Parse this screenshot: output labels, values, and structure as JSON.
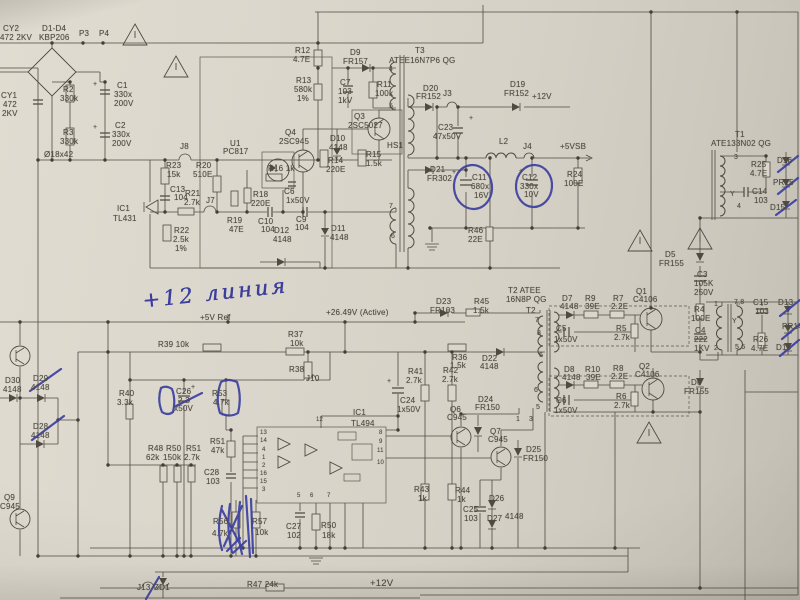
{
  "annotations": {
    "handwriting": "+12 линия"
  },
  "colors": {
    "paper": "#d8d4c9",
    "ink": "#4e4a40",
    "pen": "#3c3f9f"
  },
  "labels": [
    [
      "CY2",
      3,
      24
    ],
    [
      "472 2KV",
      0,
      33
    ],
    [
      "D1-D4",
      42,
      24
    ],
    [
      "KBP206",
      39,
      33
    ],
    [
      "P3",
      79,
      29
    ],
    [
      "P4",
      99,
      29
    ],
    [
      "C1",
      117,
      81
    ],
    [
      "330x",
      114,
      90
    ],
    [
      "200V",
      114,
      99
    ],
    [
      "R2",
      63,
      85
    ],
    [
      "330k",
      60,
      94
    ],
    [
      "R3",
      63,
      128
    ],
    [
      "330k",
      60,
      137
    ],
    [
      "C2",
      115,
      121
    ],
    [
      "330x",
      112,
      130
    ],
    [
      "200V",
      112,
      139
    ],
    [
      "CY1",
      1,
      91
    ],
    [
      "472",
      3,
      100
    ],
    [
      "2KV",
      2,
      109
    ],
    [
      "Ø18x42",
      44,
      150
    ],
    [
      "J8",
      180,
      142
    ],
    [
      "R23",
      166,
      161
    ],
    [
      "15k",
      167,
      170
    ],
    [
      "C13",
      170,
      185
    ],
    [
      "104",
      174,
      193
    ],
    [
      "R20",
      196,
      161
    ],
    [
      "510E",
      193,
      170
    ],
    [
      "R21",
      185,
      189
    ],
    [
      "2.7k",
      184,
      198
    ],
    [
      "J7",
      206,
      196
    ],
    [
      "U1",
      230,
      139
    ],
    [
      "PC817",
      223,
      147
    ],
    [
      "R18",
      253,
      190
    ],
    [
      "220E",
      251,
      199
    ],
    [
      "R19",
      227,
      216
    ],
    [
      "47E",
      229,
      225
    ],
    [
      "R22",
      174,
      226
    ],
    [
      "2.5k",
      173,
      235
    ],
    [
      "1%",
      175,
      244
    ],
    [
      "IC1",
      117,
      204
    ],
    [
      "TL431",
      113,
      214
    ],
    [
      "Q4",
      285,
      128
    ],
    [
      "2SC945",
      279,
      137
    ],
    [
      "R16 1k",
      268,
      164
    ],
    [
      "C6",
      284,
      187
    ],
    [
      "1x50V",
      286,
      196
    ],
    [
      "C10",
      258,
      217
    ],
    [
      "104",
      261,
      225
    ],
    [
      "D12",
      274,
      226
    ],
    [
      "4148",
      273,
      235
    ],
    [
      "C9",
      296,
      215
    ],
    [
      "104",
      295,
      223
    ],
    [
      "D11",
      331,
      224
    ],
    [
      "4148",
      330,
      233
    ],
    [
      "Q3",
      354,
      112
    ],
    [
      "2SC5027",
      348,
      121
    ],
    [
      "HS1",
      387,
      141
    ],
    [
      "D10",
      330,
      134
    ],
    [
      "4148",
      329,
      143
    ],
    [
      "R14",
      328,
      156
    ],
    [
      "220E",
      326,
      165
    ],
    [
      "R15",
      366,
      150
    ],
    [
      "1.5k",
      366,
      159
    ],
    [
      "R12",
      295,
      46
    ],
    [
      "4.7E",
      293,
      55
    ],
    [
      "D9",
      350,
      48
    ],
    [
      "FR157",
      343,
      57
    ],
    [
      "T3",
      415,
      46
    ],
    [
      "ATEE16N7P6 QG",
      389,
      56
    ],
    [
      "R13",
      296,
      76
    ],
    [
      "580k",
      294,
      85
    ],
    [
      "1%",
      297,
      94
    ],
    [
      "C7",
      340,
      78
    ],
    [
      "103",
      338,
      87
    ],
    [
      "1kV",
      338,
      96
    ],
    [
      "R11",
      377,
      80
    ],
    [
      "100k",
      375,
      89
    ],
    [
      "4",
      389,
      66,
      "s7"
    ],
    [
      "5",
      389,
      103,
      "s7"
    ],
    [
      "7",
      389,
      203,
      "s7"
    ],
    [
      "6",
      391,
      233,
      "s7"
    ],
    [
      "D20",
      423,
      84
    ],
    [
      "FR152",
      416,
      92
    ],
    [
      "J3",
      443,
      89
    ],
    [
      "C23",
      438,
      123
    ],
    [
      "47x50V",
      433,
      132
    ],
    [
      "D19",
      510,
      80
    ],
    [
      "FR152",
      504,
      89
    ],
    [
      "+12V",
      532,
      92
    ],
    [
      "L2",
      499,
      137
    ],
    [
      "J4",
      523,
      142
    ],
    [
      "+5VSB",
      560,
      142
    ],
    [
      "D21",
      430,
      165
    ],
    [
      "FR302",
      427,
      174
    ],
    [
      "C11",
      472,
      173
    ],
    [
      "680x",
      471,
      182
    ],
    [
      "16V",
      474,
      191
    ],
    [
      "C12",
      522,
      173
    ],
    [
      "330x",
      520,
      182
    ],
    [
      "10V",
      524,
      190
    ],
    [
      "R24",
      567,
      170
    ],
    [
      "100E",
      564,
      179
    ],
    [
      "R46",
      468,
      226
    ],
    [
      "22E",
      468,
      235
    ],
    [
      "+",
      93,
      81,
      "s7"
    ],
    [
      "+",
      93,
      124,
      "s7"
    ],
    [
      "+",
      469,
      115,
      "s7"
    ],
    [
      "+",
      452,
      169,
      "s7"
    ],
    [
      "+",
      519,
      168,
      "s7"
    ],
    [
      "+",
      387,
      378,
      "s7"
    ],
    [
      "+",
      191,
      384,
      "s7"
    ],
    [
      "T1",
      735,
      130
    ],
    [
      "ATE133N02 QG",
      711,
      139
    ],
    [
      "3",
      734,
      154,
      "s7"
    ],
    [
      "Y",
      730,
      191,
      "s7"
    ],
    [
      "4",
      737,
      203,
      "s7"
    ],
    [
      "R25",
      751,
      160
    ],
    [
      "4.7E",
      750,
      169
    ],
    [
      "D16",
      777,
      156
    ],
    [
      "PR15",
      773,
      178
    ],
    [
      "C14",
      752,
      187
    ],
    [
      "103",
      754,
      196
    ],
    [
      "D15",
      770,
      203
    ],
    [
      "D5",
      665,
      250
    ],
    [
      "FR155",
      659,
      259
    ],
    [
      "C3",
      697,
      270
    ],
    [
      "105K",
      694,
      279
    ],
    [
      "250V",
      694,
      288
    ],
    [
      "R4",
      694,
      305
    ],
    [
      "100E",
      691,
      314
    ],
    [
      "C4",
      695,
      326
    ],
    [
      "222",
      694,
      335
    ],
    [
      "1KV",
      694,
      344
    ],
    [
      "1",
      714,
      301,
      "s7"
    ],
    [
      "2",
      714,
      345,
      "s7"
    ],
    [
      "7,8",
      734,
      299,
      "s7"
    ],
    [
      "C15",
      753,
      298
    ],
    [
      "103",
      755,
      307
    ],
    [
      "Y",
      732,
      318,
      "s7"
    ],
    [
      "5,6",
      735,
      344,
      "s7"
    ],
    [
      "R26",
      753,
      335
    ],
    [
      "4.7E",
      751,
      344
    ],
    [
      "D13",
      778,
      298
    ],
    [
      "PR14",
      782,
      322
    ],
    [
      "D14",
      776,
      343
    ],
    [
      "T2 ATEE",
      508,
      286
    ],
    [
      "16N8P QG",
      506,
      295
    ],
    [
      "T2",
      526,
      306
    ],
    [
      "D7",
      562,
      294
    ],
    [
      "4148",
      560,
      302
    ],
    [
      "R9",
      585,
      294
    ],
    [
      "39E",
      585,
      302
    ],
    [
      "R7",
      613,
      294
    ],
    [
      "2.2E",
      611,
      302
    ],
    [
      "Q1",
      636,
      287
    ],
    [
      "C4106",
      633,
      295
    ],
    [
      "C5",
      556,
      324
    ],
    [
      "1x50V",
      554,
      335
    ],
    [
      "R5",
      616,
      324
    ],
    [
      "2.7k",
      614,
      333
    ],
    [
      "7",
      535,
      317,
      "s7"
    ],
    [
      "8",
      537,
      330,
      "s7"
    ],
    [
      "6",
      539,
      352,
      "s7"
    ],
    [
      "D8",
      564,
      365
    ],
    [
      "4148",
      562,
      373
    ],
    [
      "R10",
      585,
      365
    ],
    [
      "39E",
      586,
      373
    ],
    [
      "R8",
      613,
      364
    ],
    [
      "2.2E",
      611,
      372
    ],
    [
      "Q2",
      639,
      362
    ],
    [
      "C4106",
      635,
      370
    ],
    [
      "C6",
      556,
      396
    ],
    [
      "1x50V",
      554,
      406
    ],
    [
      "R6",
      616,
      392
    ],
    [
      "2.7k",
      614,
      401
    ],
    [
      "6",
      534,
      387,
      "s7"
    ],
    [
      "5",
      536,
      404,
      "s7"
    ],
    [
      "D6",
      691,
      378
    ],
    [
      "FR155",
      684,
      387
    ],
    [
      "+5V Ref",
      200,
      313
    ],
    [
      "R39 10k",
      158,
      340
    ],
    [
      "R37",
      288,
      330
    ],
    [
      "10k",
      290,
      339
    ],
    [
      "R38",
      289,
      365
    ],
    [
      "J10",
      306,
      374
    ],
    [
      "R40",
      119,
      389
    ],
    [
      "3.3k",
      117,
      398
    ],
    [
      "C26",
      176,
      387
    ],
    [
      "2.2",
      178,
      396
    ],
    [
      "x50V",
      174,
      404
    ],
    [
      "R53",
      212,
      389
    ],
    [
      "4.7k",
      213,
      398
    ],
    [
      "+26.49V (Active)",
      326,
      308
    ],
    [
      "D23",
      436,
      297
    ],
    [
      "FR103",
      430,
      306
    ],
    [
      "R45",
      474,
      297
    ],
    [
      "1.5k",
      473,
      306
    ],
    [
      "R36",
      452,
      353
    ],
    [
      "1.5k",
      450,
      361
    ],
    [
      "D22",
      482,
      354
    ],
    [
      "4148",
      480,
      362
    ],
    [
      "R41",
      408,
      367
    ],
    [
      "2.7k",
      406,
      376
    ],
    [
      "R42",
      443,
      366
    ],
    [
      "2.7k",
      442,
      375
    ],
    [
      "C24",
      400,
      396
    ],
    [
      "1x50V",
      397,
      405
    ],
    [
      "IC1",
      353,
      408
    ],
    [
      "TL494",
      351,
      419
    ],
    [
      "Q6",
      450,
      405
    ],
    [
      "C945",
      447,
      413
    ],
    [
      "Q7",
      490,
      427
    ],
    [
      "C945",
      488,
      435
    ],
    [
      "D24",
      478,
      395
    ],
    [
      "FR150",
      475,
      403
    ],
    [
      "D25",
      526,
      445
    ],
    [
      "FR150",
      523,
      454
    ],
    [
      "R43",
      414,
      485
    ],
    [
      "1k",
      418,
      494
    ],
    [
      "R44",
      455,
      486
    ],
    [
      "1k",
      457,
      495
    ],
    [
      "C25",
      463,
      505
    ],
    [
      "103",
      464,
      514
    ],
    [
      "D26",
      489,
      494
    ],
    [
      "D27",
      487,
      514
    ],
    [
      "4148",
      505,
      512
    ],
    [
      "R48",
      148,
      444
    ],
    [
      "62k",
      146,
      453
    ],
    [
      "R50",
      166,
      444
    ],
    [
      "150k",
      163,
      453
    ],
    [
      "R51",
      186,
      444
    ],
    [
      "2.7k",
      184,
      453
    ],
    [
      "R51",
      210,
      437
    ],
    [
      "47k",
      211,
      446
    ],
    [
      "C28",
      204,
      468
    ],
    [
      "103",
      206,
      477
    ],
    [
      "R56",
      213,
      517
    ],
    [
      "4.7k",
      212,
      529
    ],
    [
      "R57",
      252,
      517
    ],
    [
      "10k",
      255,
      528
    ],
    [
      "C27",
      286,
      522
    ],
    [
      "102",
      287,
      531
    ],
    [
      "R50",
      321,
      521
    ],
    [
      "18k",
      322,
      531
    ],
    [
      "ZD1",
      154,
      583
    ],
    [
      "J13",
      137,
      583
    ],
    [
      "R47 24k",
      247,
      580
    ],
    [
      "+12V",
      370,
      579,
      "s9"
    ],
    [
      "D30",
      5,
      376
    ],
    [
      "4148",
      3,
      385
    ],
    [
      "D29",
      33,
      374
    ],
    [
      "4148",
      31,
      383
    ],
    [
      "D28",
      33,
      422
    ],
    [
      "4148",
      31,
      431
    ],
    [
      "Q9",
      4,
      493
    ],
    [
      "C945",
      0,
      502
    ],
    [
      "13",
      260,
      430,
      "s6"
    ],
    [
      "14",
      260,
      438,
      "s6"
    ],
    [
      "4",
      262,
      447,
      "s6"
    ],
    [
      "1",
      262,
      455,
      "s6"
    ],
    [
      "2",
      262,
      463,
      "s6"
    ],
    [
      "16",
      260,
      471,
      "s6"
    ],
    [
      "15",
      260,
      479,
      "s6"
    ],
    [
      "3",
      262,
      487,
      "s6"
    ],
    [
      "8",
      379,
      430,
      "s6"
    ],
    [
      "9",
      379,
      439,
      "s6"
    ],
    [
      "11",
      377,
      448,
      "s6"
    ],
    [
      "10",
      377,
      460,
      "s6"
    ],
    [
      "5",
      297,
      493,
      "s6"
    ],
    [
      "6",
      310,
      493,
      "s6"
    ],
    [
      "7",
      327,
      493,
      "s6"
    ],
    [
      "12",
      316,
      417,
      "s6"
    ],
    [
      "1",
      516,
      416,
      "s7"
    ],
    [
      "3",
      529,
      416,
      "s7"
    ]
  ]
}
